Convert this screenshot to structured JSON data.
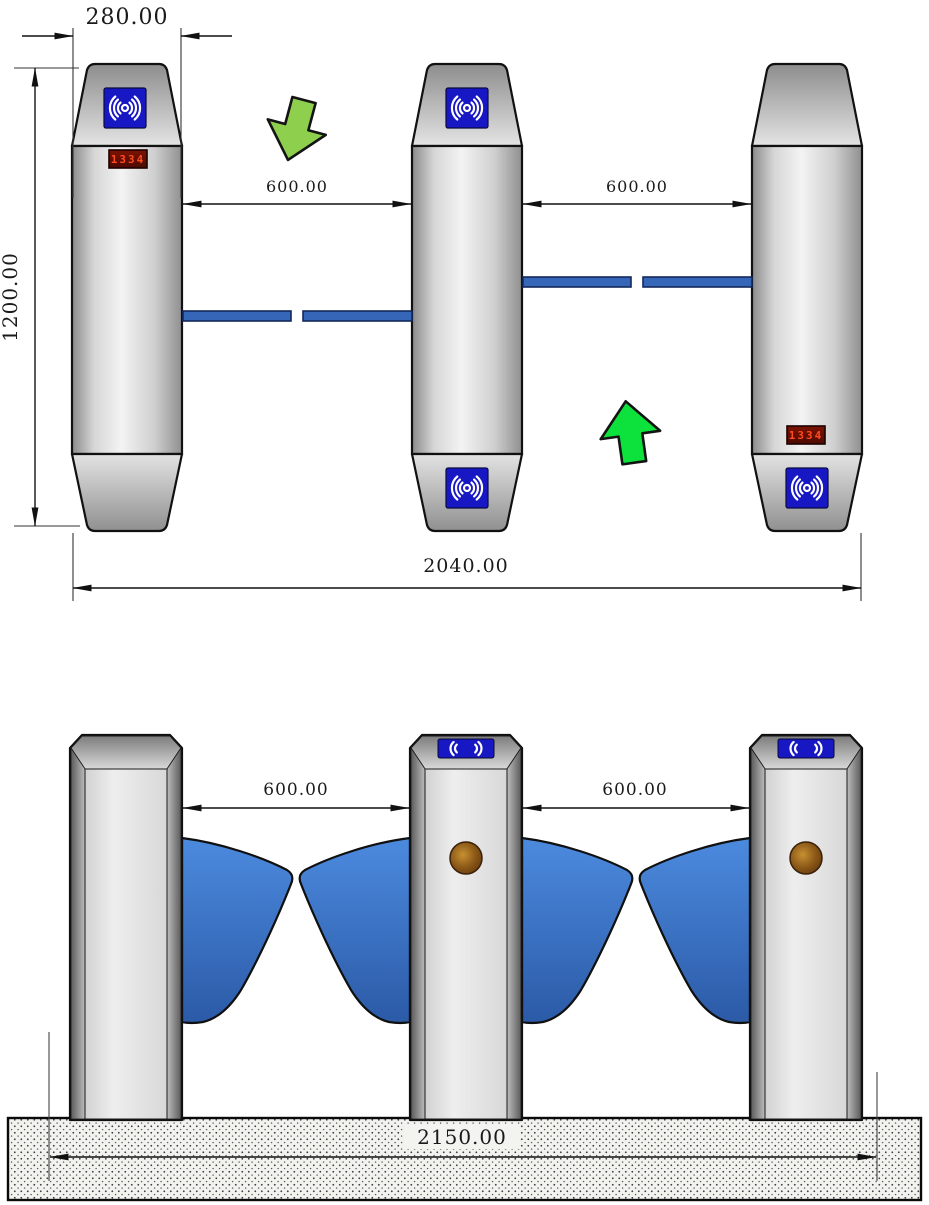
{
  "top_view": {
    "dim_cabinet_width": "280.00",
    "dim_cabinet_length": "1200.00",
    "dim_lane_left": "600.00",
    "dim_lane_right": "600.00",
    "dim_overall_width": "2040.00",
    "led_display_left": "1334",
    "led_display_right": "1334"
  },
  "front_view": {
    "dim_lane_left": "600.00",
    "dim_lane_right": "600.00",
    "dim_overall_width": "2150.00"
  },
  "icons": {
    "rfid_reader": "rfid-reader-icon",
    "down_arrow": "down-arrow-icon",
    "up_arrow": "up-arrow-icon",
    "indicator_light": "indicator-light-icon"
  },
  "colors": {
    "rfid_blue": "#1717c4",
    "led_digit_red": "#ff4a22",
    "led_background": "#5e0c00",
    "down_arrow_green": "#8ed04e",
    "up_arrow_green": "#0ce23b",
    "flap_blue": "#3566b8",
    "wing_blue_top": "#4c8ade",
    "wing_blue_bottom": "#2b5aa7",
    "outline_black": "#111111"
  }
}
